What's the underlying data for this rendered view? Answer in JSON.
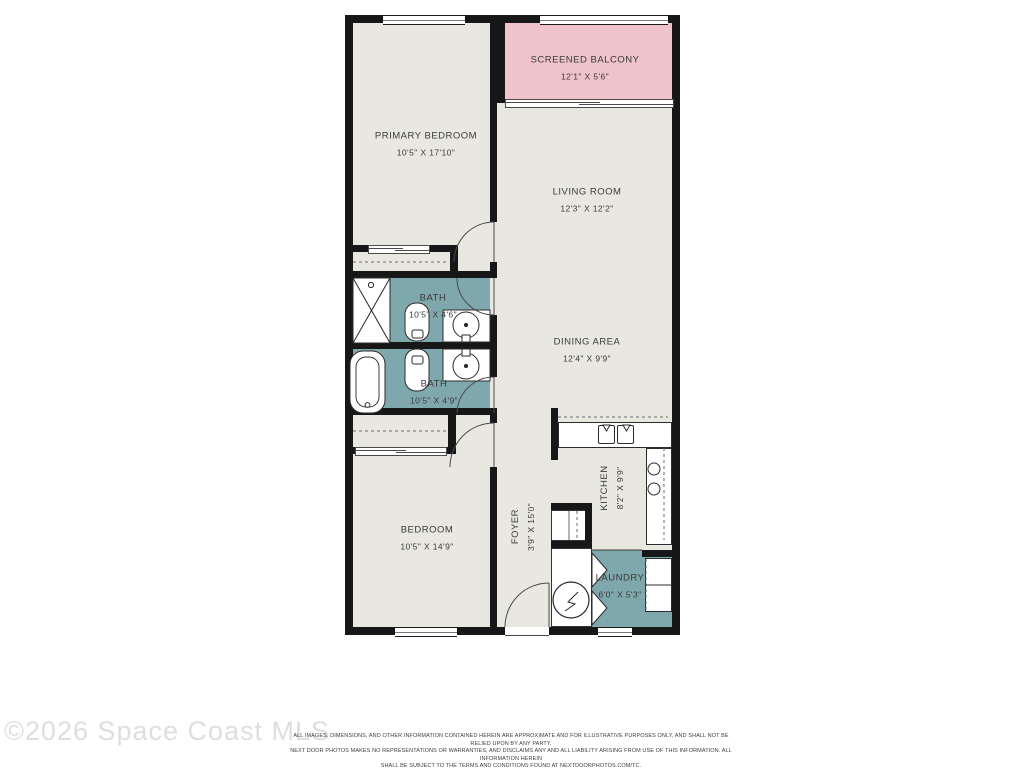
{
  "plan": {
    "rooms": {
      "screened_balcony": {
        "name": "SCREENED BALCONY",
        "dims": "12'1\" X 5'6\""
      },
      "primary_bedroom": {
        "name": "PRIMARY BEDROOM",
        "dims": "10'5\" X 17'10\""
      },
      "living_room": {
        "name": "LIVING ROOM",
        "dims": "12'3\" X 12'2\""
      },
      "bath_upper": {
        "name": "BATH",
        "dims": "10'5\" X 4'6\""
      },
      "bath_lower": {
        "name": "BATH",
        "dims": "10'5\" X 4'9\""
      },
      "dining_area": {
        "name": "DINING AREA",
        "dims": "12'4\" X 9'9\""
      },
      "bedroom": {
        "name": "BEDROOM",
        "dims": "10'5\" X 14'9\""
      },
      "foyer": {
        "name": "FOYER",
        "dims": "3'9\" X 15'0\""
      },
      "kitchen": {
        "name": "KITCHEN",
        "dims": "8'2\" X 9'9\""
      },
      "laundry": {
        "name": "LAUNDRY",
        "dims": "6'0\" X 5'3\""
      }
    },
    "colors": {
      "floor": "#e9e8e0",
      "wet_area": "#7fa8ad",
      "balcony": "#eec3c9",
      "wall": "#171717"
    }
  },
  "watermark": "©2026 Space Coast MLS",
  "disclaimer": {
    "line1": "ALL IMAGES, DIMENSIONS, AND OTHER INFORMATION CONTAINED HEREIN ARE APPROXIMATE AND FOR ILLUSTRATIVE PURPOSES ONLY, AND SHALL NOT BE RELIED UPON BY ANY PARTY.",
    "line2": "NEXT DOOR PHOTOS MAKES NO REPRESENTATIONS OR WARRANTIES, AND DISCLAIMS ANY AND ALL LIABILITY ARISING FROM USE OF THIS INFORMATION. ALL INFORMATION HEREIN",
    "line3": "SHALL BE SUBJECT TO THE TERMS AND CONDITIONS FOUND AT NEXTDOORPHOTOS.COM/TC."
  }
}
